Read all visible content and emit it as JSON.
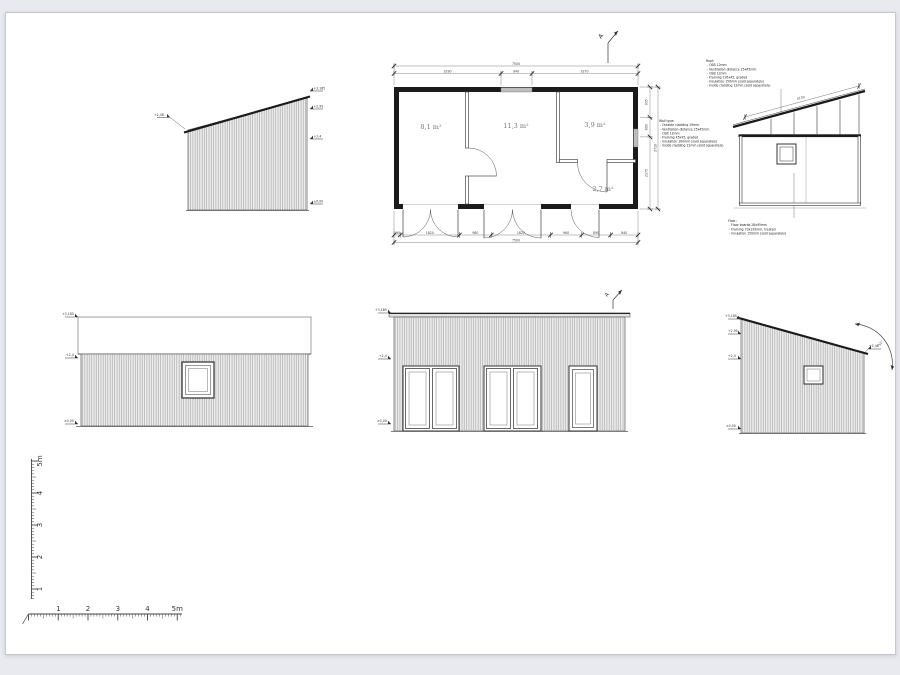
{
  "sheet": {
    "background": "#e9eaf0",
    "paper": "#ffffff"
  },
  "plan": {
    "section_mark": "A",
    "rooms": [
      {
        "label": "8,1 m²"
      },
      {
        "label": "11,3 m²"
      },
      {
        "label": "3,9 m²"
      },
      {
        "label": "2,7 m²"
      }
    ],
    "dims_top": {
      "total": "7500",
      "segments": [
        "3290",
        "940",
        "3270"
      ]
    },
    "dims_bottom": {
      "total": "7500",
      "segments": [
        "190",
        "1820",
        "980",
        "1820",
        "960",
        "890",
        "840"
      ]
    },
    "dims_right": {
      "total": "3710",
      "segments": [
        "935",
        "600",
        "2175"
      ]
    }
  },
  "section": {
    "roof_dim": "4130",
    "roof_notes": {
      "title": "Roof:",
      "lines": [
        "- OSB 12mm",
        "- Ventilation distance 25x45mm",
        "- OSB 12mm",
        "- Framing 195x45, graded",
        "- Insulation 150mm (sold separately)",
        "- Inside cladding 12mm (sold separately)"
      ]
    },
    "wall_notes": {
      "title": "Wall type:",
      "lines": [
        "- Outside cladding 19mm",
        "- Ventilation distance 25x45mm",
        "- OSB 12mm",
        "- Framing 45x95, graded",
        "- Insulation 100mm (sold separately)",
        "- Inside cladding 12mm (sold separately)"
      ]
    },
    "floor_notes": {
      "title": "Floor:",
      "lines": [
        "- Floor boards 28x95mm",
        "- Framing 70x195mm, treated",
        "- Insulation 150mm (sold separately)"
      ]
    }
  },
  "elevations": {
    "left_side": {
      "eave_level": "+2,48",
      "levels": [
        "+3,185",
        "+2,95",
        "+2,4",
        "±0,00"
      ]
    },
    "rear": {
      "levels": [
        "+3,185",
        "+2,4",
        "±0,00"
      ]
    },
    "front": {
      "levels": [
        "+3,185",
        "+2,4",
        "±0,00"
      ],
      "section_mark": "A"
    },
    "right_side": {
      "levels": [
        "+3,185",
        "+2,95",
        "+2,4",
        "±0,00"
      ],
      "eave_level": "+2,48",
      "roof_angle": "15°"
    }
  },
  "scale_bar": {
    "vertical_labels": [
      "5m",
      "4",
      "3",
      "2",
      "1"
    ],
    "horizontal_labels": [
      "1",
      "2",
      "3",
      "4",
      "5m"
    ]
  }
}
